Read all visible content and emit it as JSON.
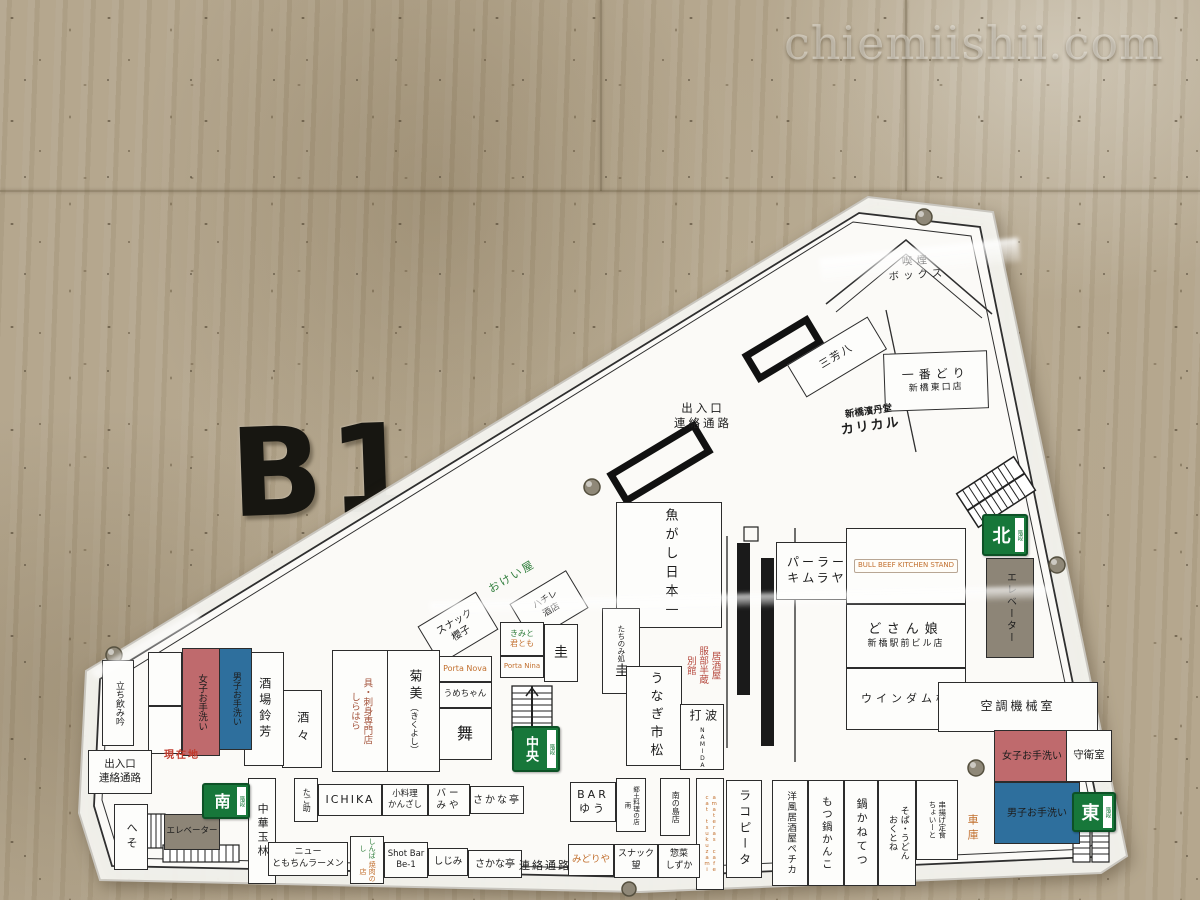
{
  "watermark": "chiemiishii.com",
  "wall_sign": "B1",
  "exits": {
    "north": "北",
    "central": "中央",
    "south": "南",
    "east": "東",
    "stairs": "階段"
  },
  "corridors": {
    "top_entrance": "出入口\n連絡通路",
    "left_entrance": "出入口\n連絡通路",
    "passage": "連絡通路",
    "you_are_here": "現在地"
  },
  "facilities": {
    "smoking_box": "喫煙\nボックス",
    "elevator_right": "エレベーター",
    "elevator_left": "エレベーター",
    "aircon_room": "空調機械室",
    "women_restroom_right": "女子お手洗い",
    "men_restroom_right": "男子お手洗い",
    "women_restroom_left": "女子お手洗い",
    "men_restroom_left": "男子お手洗い",
    "guard_room": "守衛室",
    "garage": "車庫"
  },
  "shops": {
    "miyoshiha": "三芳八",
    "ichibandori_name": "一番どり",
    "ichibandori_branch": "新橋東口店",
    "karikaru_co": "新橋濱丹堂",
    "karikaru_name": "カリカル",
    "uogashi_nihonichi": "魚がし日本一",
    "parlor_kimuraya": "パーラー\nキムラヤ",
    "beef_kitchen_stand": "BULL BEEF KITCHEN STAND",
    "dosanko_name": "どさん娘",
    "dosanko_branch": "新橋駅前ビル店",
    "windam": "ウインダム株",
    "hattori_hanzo": "居酒屋\n服部半蔵\n別館",
    "tachinomi_kei_prefix": "たちのみ処",
    "tachinomi_kei_name": "圭",
    "unagi_ichimatsu": "うなぎ市松",
    "namida": "波打",
    "namida_romaji": "NAMIDA",
    "okeiya": "おけい屋",
    "hachire": "ハチレ\n酒店",
    "snack_sakurako": "スナック\n櫻子",
    "kimito": "きみと",
    "kimitomo": "君とも",
    "porta_nina": "Porta Nina",
    "kei2": "圭",
    "porta_nova": "Porta Nova",
    "umechan": "うめちゃん",
    "mai": "舞",
    "kikumi_name": "菊美",
    "kikumi_kana": "（きくよし）",
    "shirahara": "具・刺身専門店\nしらはら",
    "suzuyoshi": "酒場鈴芳",
    "shusshu": "酒々",
    "tachinomi_gin": "立ち飲み吟",
    "heso": "へそ",
    "chuka_gyokurin": "中華玉林",
    "tagosuke": "たご助",
    "ichika": "ICHIKA",
    "kanzashi": "小料理\nかんざし",
    "bar_miya": "バー\nみや",
    "sakanatei_1": "さかな亭",
    "new_tomochin": "ニュー\nともちんラーメン",
    "shinbashi": "しんばし",
    "yakiniku": "焼肉の店",
    "shotbar_be1": "Shot Bar\nBe-1",
    "shijimi": "しじみ",
    "sakanatei_2": "さかな亭",
    "bar_yuu": "BAR\nゆう",
    "kyodo_minami": "郷土料理の店\n南",
    "minami_no_shima": "南の島店",
    "amateras": "amateras cafe\ncat tsukuzami",
    "la_copita": "ラコピータ",
    "midoriya": "みどりや",
    "snack_nozomi": "スナック\n望",
    "sozai_shizuka": "惣菜\nしずか",
    "pechka": "洋風居酒屋ペチカ",
    "motsunabe_kanko": "もつ鍋かんこ",
    "nabe_kanetetsu": "鍋かねてつ",
    "okutone": "そば・うどん\nおくとね",
    "choito": "串揚げ定食\nちょいーと"
  }
}
